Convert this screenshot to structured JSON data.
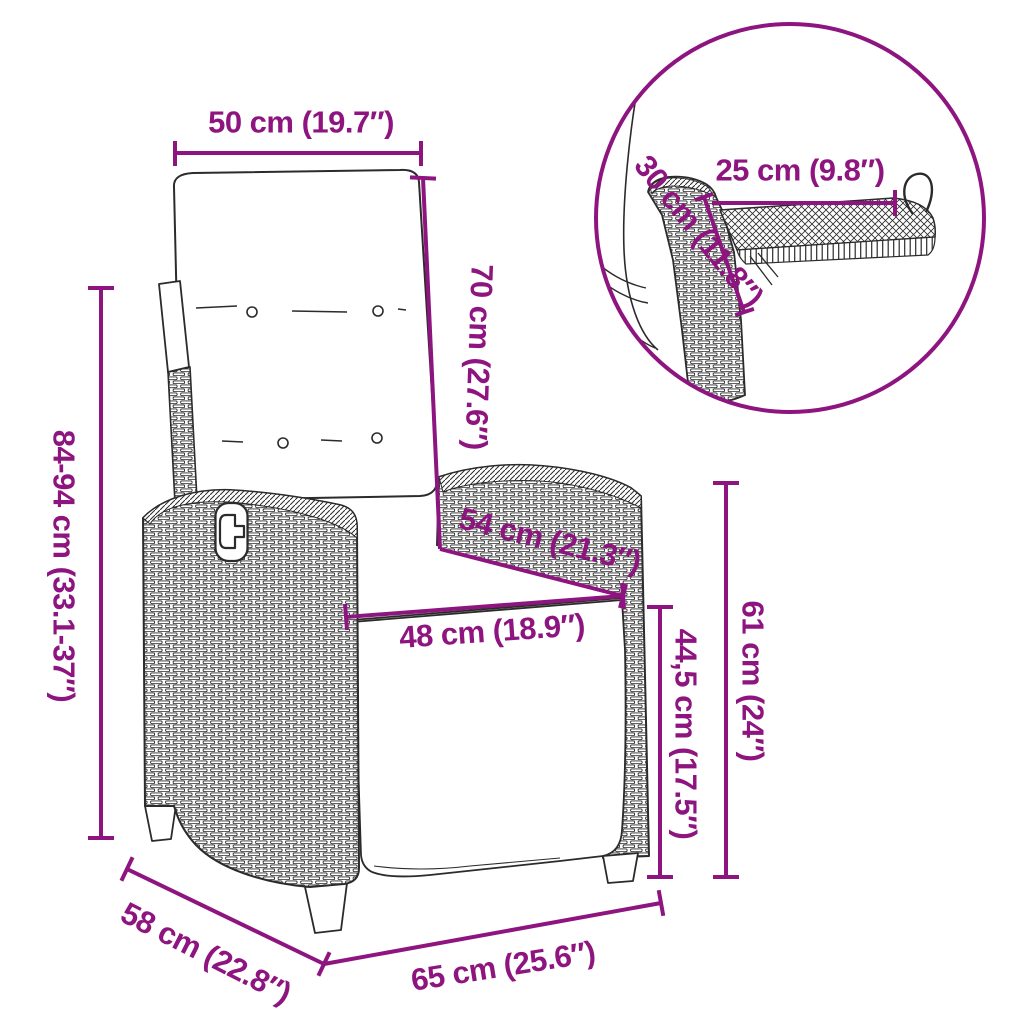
{
  "diagram": {
    "accent_color": "#8E157F",
    "line_color": "#2b2b2b",
    "subject": "reclining wicker garden chair with cushion and fold-out side tray"
  },
  "dimensions": [
    {
      "id": "top-width",
      "text": "50 cm (19.7″)"
    },
    {
      "id": "backrest-height",
      "text": "70 cm (27.6″)"
    },
    {
      "id": "total-height",
      "text": "84-94 cm (33.1-37″)"
    },
    {
      "id": "seat-depth",
      "text": "54 cm (21.3″)"
    },
    {
      "id": "seat-width",
      "text": "48 cm (18.9″)"
    },
    {
      "id": "seat-height",
      "text": "44,5 cm (17.5″)"
    },
    {
      "id": "armrest-height",
      "text": "61 cm (24″)"
    },
    {
      "id": "base-depth",
      "text": "58 cm (22.8″)"
    },
    {
      "id": "base-width",
      "text": "65 cm (25.6″)"
    },
    {
      "id": "tray-width",
      "text": "25 cm (9.8″)"
    },
    {
      "id": "tray-depth",
      "text": "30 cm (11.8″)"
    }
  ]
}
